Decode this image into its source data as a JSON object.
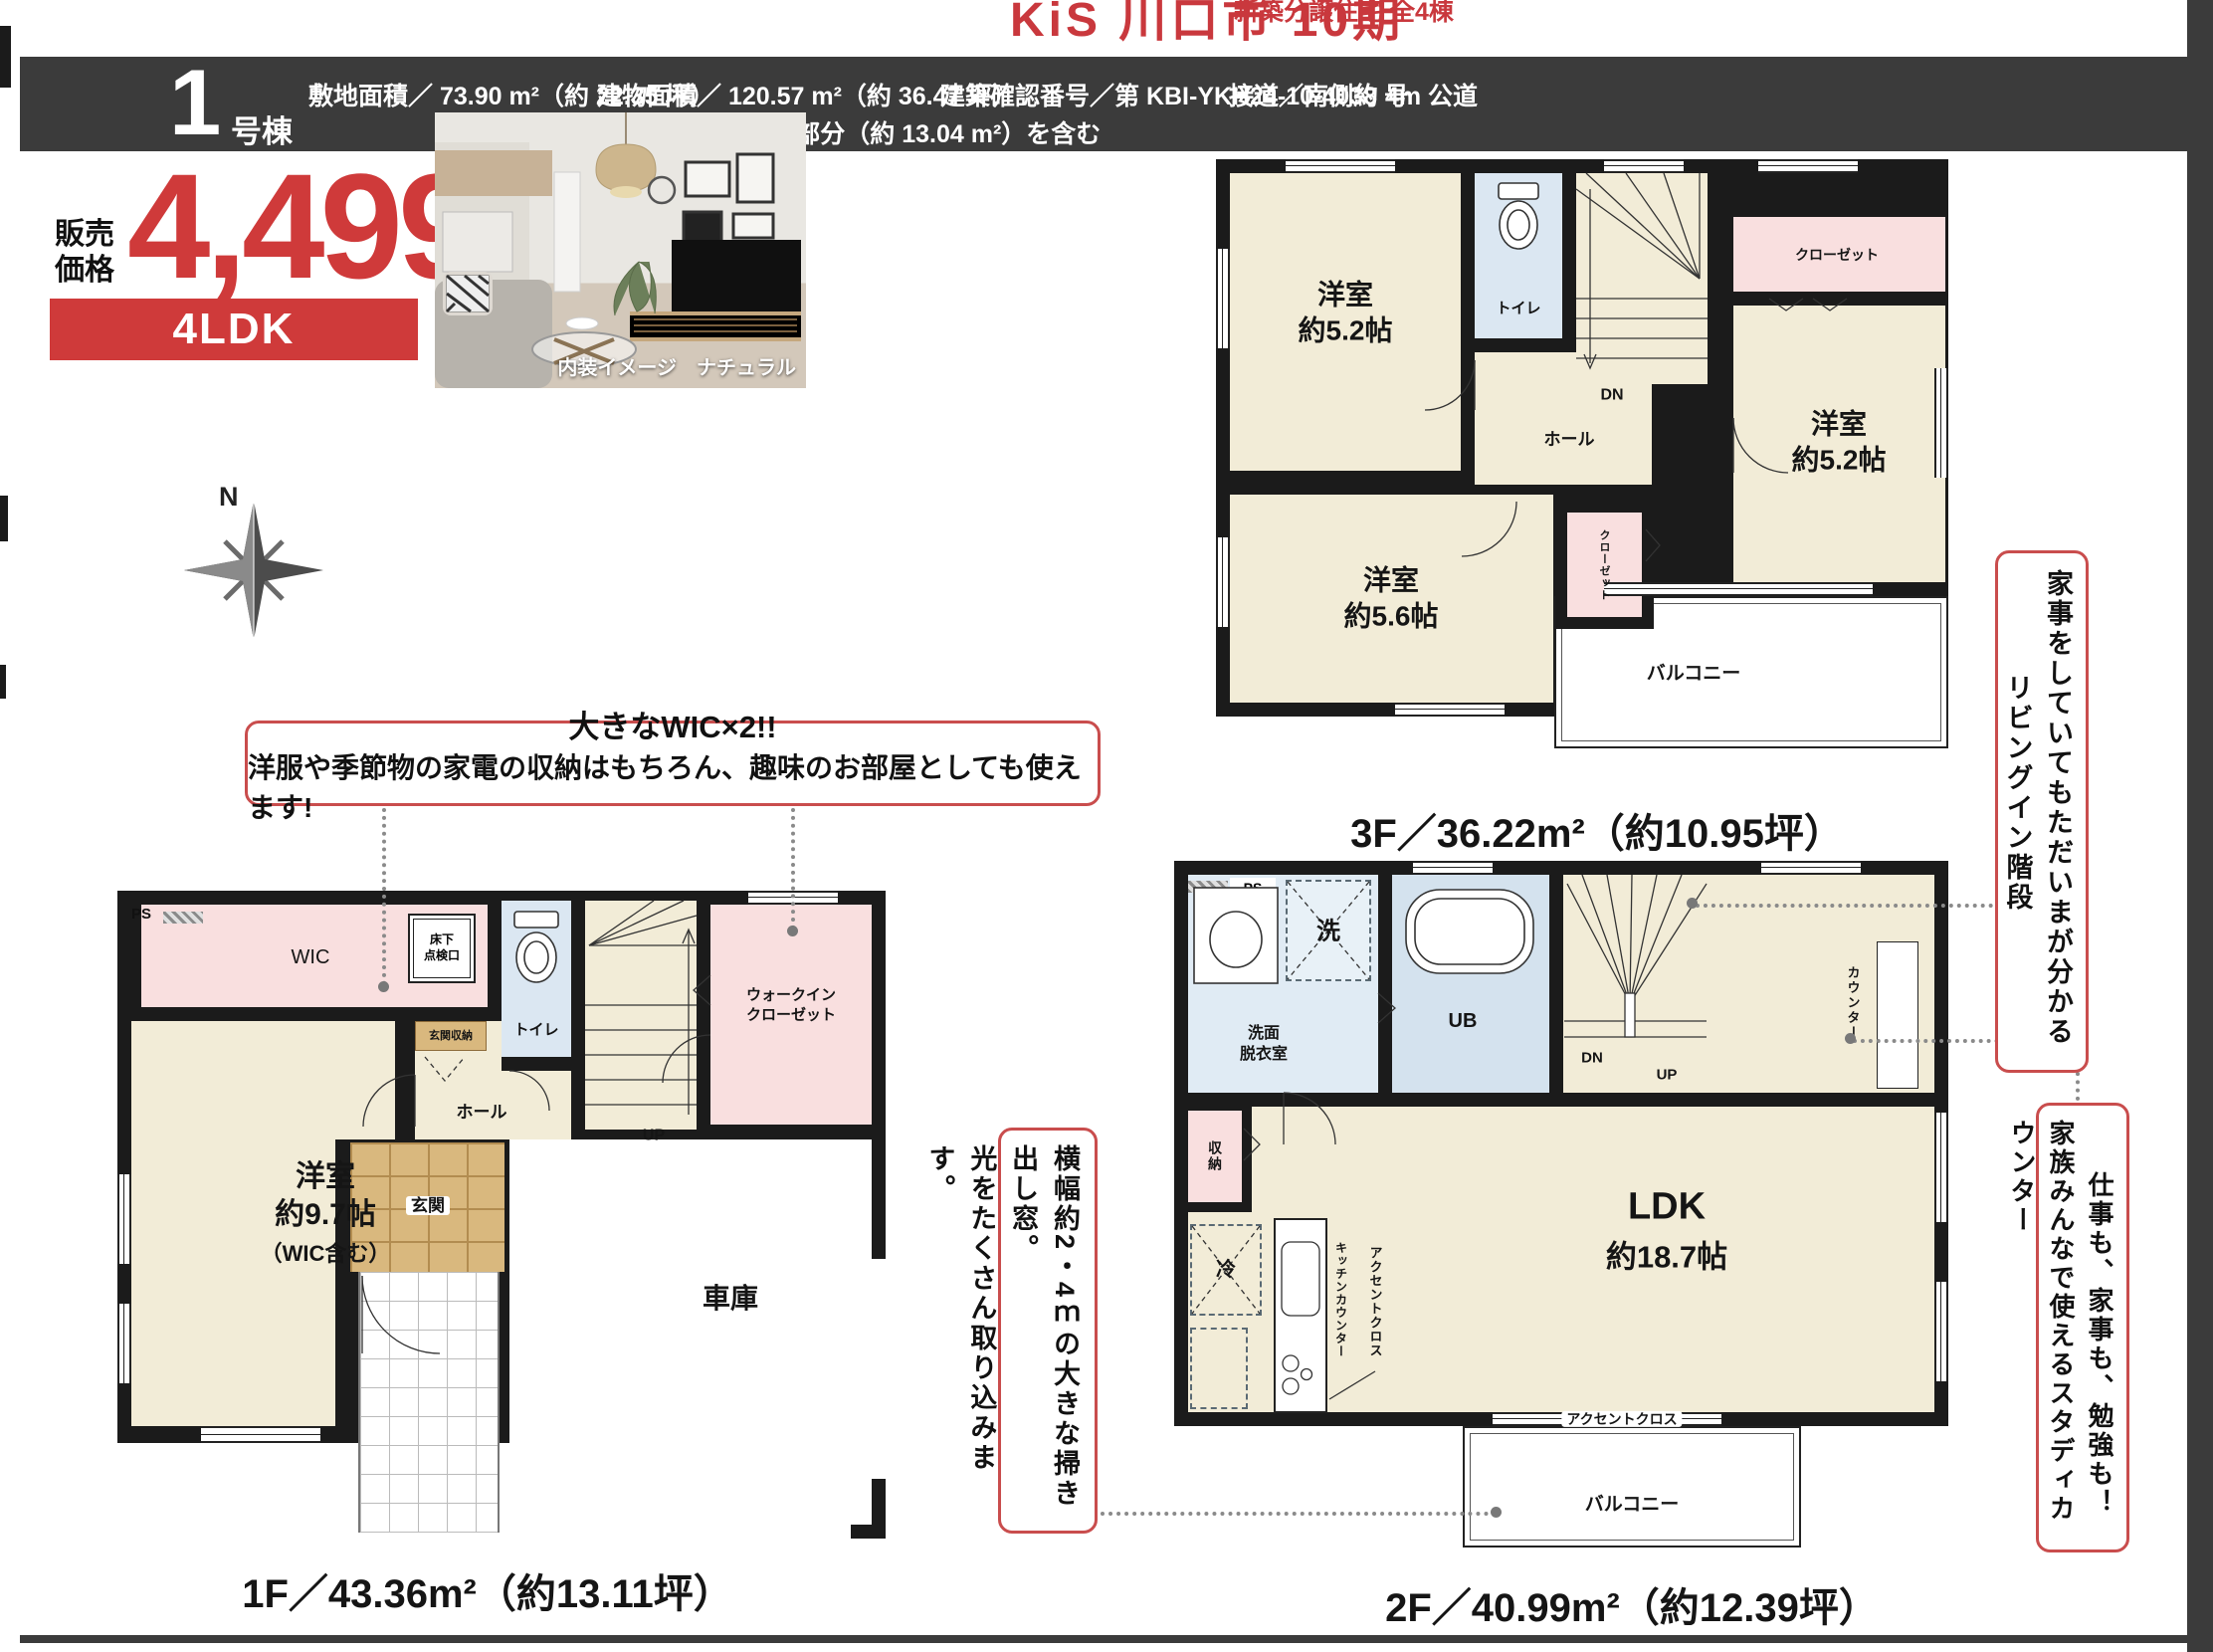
{
  "colors": {
    "accent_red": "#cf3a3a",
    "header_dark": "#3b3b3b",
    "wall_black": "#1b1b1b",
    "room_cream": "#f2ecd7",
    "room_pink": "#f9dfdf",
    "room_blue": "#dbe7f2",
    "tile_tan": "#d9b87e"
  },
  "masthead": {
    "title": "KiS 川口市 10期",
    "subtitle": "新築分譲住宅 全4棟"
  },
  "header": {
    "unit_number": "1",
    "unit_label": "号棟",
    "land_area": "敷地面積／ 73.90 m²（約 22.35 坪）",
    "building_area": "建物面積／ 120.57 m²（約 36.47 坪）",
    "building_note": "※建築面積に車庫部分（約 13.04 m²）を含む",
    "confirmation": "建築確認番号／第 KBI-YKH24-10-4038 号",
    "road": "接道／南側約 4m 公道"
  },
  "price": {
    "label1": "販売",
    "label2": "価格",
    "amount": "4,499",
    "tax1": "税込",
    "tax2": "万円",
    "plan_type": "4LDK"
  },
  "photo": {
    "caption": "内装イメージ　ナチュラル"
  },
  "compass": {
    "north": "N"
  },
  "callouts": {
    "wic_title": "大きなWIC×2!!",
    "wic_body": "洋服や季節物の家電の収納はもちろん、趣味のお部屋としても使えます!",
    "window_col1": "横幅約2・4ｍの大きな掃き出し窓。",
    "window_col2": "光をたくさん取り込みます。",
    "stairs_col1": "家事をしていてもただいまが分かる",
    "stairs_col2": "リビングイン階段",
    "counter_col1": "仕事も、家事も、勉強も！",
    "counter_col2": "家族みんなで使えるスタディカウンター"
  },
  "floor3": {
    "title": "3F／36.22m²（約10.95坪）",
    "room_a1": "洋室",
    "room_a2": "約5.2帖",
    "toilet": "トイレ",
    "dn": "DN",
    "hall": "ホール",
    "closet_top": "クローゼット",
    "closet_mid": "クローゼット",
    "room_b1": "洋室",
    "room_b2": "約5.2帖",
    "room_c1": "洋室",
    "room_c2": "約5.6帖",
    "balcony": "バルコニー"
  },
  "floor1": {
    "title": "1F／43.36m²（約13.11坪）",
    "ps": "PS",
    "wic": "WIC",
    "inspection1": "床下",
    "inspection2": "点検口",
    "toilet": "トイレ",
    "up": "UP",
    "wicloset1": "ウォークイン",
    "wicloset2": "クローゼット",
    "entry_storage": "玄関収納",
    "hall": "ホール",
    "entry": "玄関",
    "room1": "洋室",
    "room2": "約9.7帖",
    "room3": "（WIC含む）",
    "garage": "車庫"
  },
  "floor2": {
    "title": "2F／40.99m²（約12.39坪）",
    "ps": "PS",
    "wash": "洗",
    "washroom1": "洗面",
    "washroom2": "脱衣室",
    "ub": "UB",
    "dn": "DN",
    "up": "UP",
    "counter": "カウンター",
    "storage": "収納",
    "fridge": "冷",
    "kitchen_counter": "キッチンカウンター",
    "accent_v": "アクセントクロス",
    "accent_h": "アクセントクロス",
    "ldk1": "LDK",
    "ldk2": "約18.7帖",
    "balcony": "バルコニー"
  }
}
